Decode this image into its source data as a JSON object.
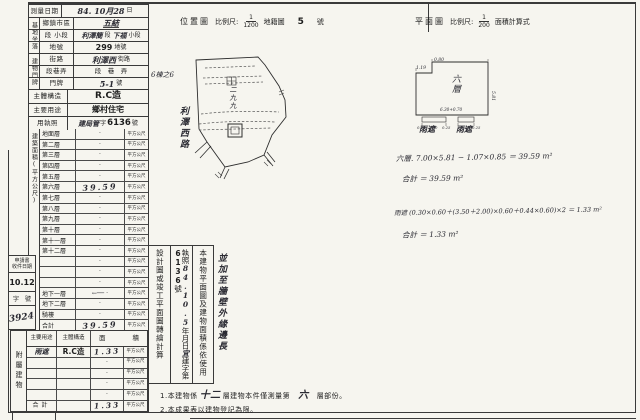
{
  "survey": {
    "label": "測量日期",
    "hand": "84. 10月28",
    "suffix": "日"
  },
  "site": {
    "group": "基地坐落",
    "district": {
      "label": "鄉鎮市區",
      "value": "五結"
    },
    "section": {
      "label": "段 小段",
      "hand1": "利澤簡",
      "p1": "段",
      "hand2": "下福",
      "p2": "小段"
    },
    "parcel": {
      "label": "地號",
      "value": "299",
      "suffix": "地號"
    }
  },
  "addr": {
    "group": "建物門牌",
    "street": {
      "label": "街路",
      "value": "利澤西",
      "suffix": "街路"
    },
    "lane": {
      "label": "段巷弄",
      "value": "段　巷　弄"
    },
    "number": {
      "label": "門牌",
      "hand": "5-1",
      "p": "號",
      "extra": "6棟之6"
    }
  },
  "structure": {
    "label": "主體構造",
    "value": "R.C造"
  },
  "usage": {
    "label": "主要用途",
    "value": "鄉村住宅"
  },
  "license": {
    "label": "用執照",
    "hand": "建局管",
    "mid": "字",
    "no": "6136",
    "suffix": "號"
  },
  "floor": {
    "group": "建築面積(平方公尺)",
    "unit": "平方公尺",
    "arrow": "←──",
    "rows": [
      {
        "label": "地面層",
        "value": "·"
      },
      {
        "label": "第二層",
        "value": "·"
      },
      {
        "label": "第三層",
        "value": "·"
      },
      {
        "label": "第四層",
        "value": "·"
      },
      {
        "label": "第五層",
        "value": "·"
      },
      {
        "label": "第六層",
        "value": "39.59"
      },
      {
        "label": "第七層",
        "value": "·"
      },
      {
        "label": "第八層",
        "value": "·"
      },
      {
        "label": "第九層",
        "value": "·"
      },
      {
        "label": "第十層",
        "value": "·"
      },
      {
        "label": "第十一層",
        "value": "·"
      },
      {
        "label": "第十二層",
        "value": "·"
      },
      {
        "label": "",
        "value": "·"
      },
      {
        "label": "",
        "value": "·"
      },
      {
        "label": "",
        "value": "·"
      },
      {
        "label": "地下一層",
        "value": "·"
      },
      {
        "label": "地下二層",
        "value": "·"
      },
      {
        "label": "騎樓",
        "value": "·"
      },
      {
        "label": "合計",
        "value": "39.59"
      }
    ]
  },
  "apply": {
    "line1": "申請書",
    "line2": "收件日期",
    "date": "10.12",
    "no_label": "字　號",
    "no_value": "3924"
  },
  "annex": {
    "group": "附屬建物",
    "h_usage": "主要用途",
    "h_struct": "主體構造",
    "h_area_l": "面",
    "h_area_r": "積",
    "unit": "平方公尺",
    "rows": [
      {
        "usage": "雨遮",
        "structure": "R.C造",
        "value": "1.33"
      },
      {
        "usage": "",
        "structure": "",
        "value": "·"
      },
      {
        "usage": "",
        "structure": "",
        "value": "·"
      },
      {
        "usage": "",
        "structure": "",
        "value": "·"
      },
      {
        "usage": "",
        "structure": "",
        "value": "·"
      },
      {
        "usage": "合計",
        "structure": "",
        "value": "1.33"
      }
    ]
  },
  "statement": {
    "c1": "本建物平面圖及建物面積係依使用",
    "c2_pre": "執照",
    "c2_date": "84.10.5",
    "c2_ymd": "年月日",
    "c2_hand": "宜",
    "c2_mid": "建字第",
    "c2_no": "6136",
    "c2_suf": "號",
    "c3": "設計圖或竣工平面圖轉繪計算",
    "note": "並加至牆壁外緣邊長"
  },
  "notes": {
    "n1a": "1.本建物係",
    "n1h1": "十二",
    "n1b": "層建物本件僅測量第",
    "n1h2": "六",
    "n1c": "層部份。",
    "n2": "2.本成果表以建物登記為限。"
  },
  "headers": {
    "loc": "位置圖",
    "scale": "比例尺:",
    "loc_num": "1",
    "loc_den": "1200",
    "cad": "地籍圖",
    "cad_no": "5",
    "cad_suf": "號",
    "plan": "平面圖",
    "plan_num": "1",
    "plan_den": "200",
    "calc": "面積計算式"
  },
  "map": {
    "road": "利澤西路",
    "parcel": "二九九"
  },
  "plan": {
    "floor": "六層",
    "canopy1": "雨遮",
    "canopy2": "雨遮",
    "d_notch": "1.19",
    "d_top": "0.80",
    "d_right": "5.81",
    "d_bottom": "6.30+0.70",
    "d1": "0.25",
    "d2": "1.50",
    "d3": "0.25",
    "d4": "3.00",
    "d5": "0.25"
  },
  "calc": {
    "l1": "六層. 7.00×5.81 − 1.07×0.85 ＝ 39.59 m²",
    "l2": "合計 ＝ 39.59 m²",
    "l3": "雨遮 (0.30×0.60＋(3.50＋2.00)×0.60＋0.44×0.60)×2 ＝ 1.33 m²",
    "l4": "合計 ＝ 1.33 m²"
  }
}
